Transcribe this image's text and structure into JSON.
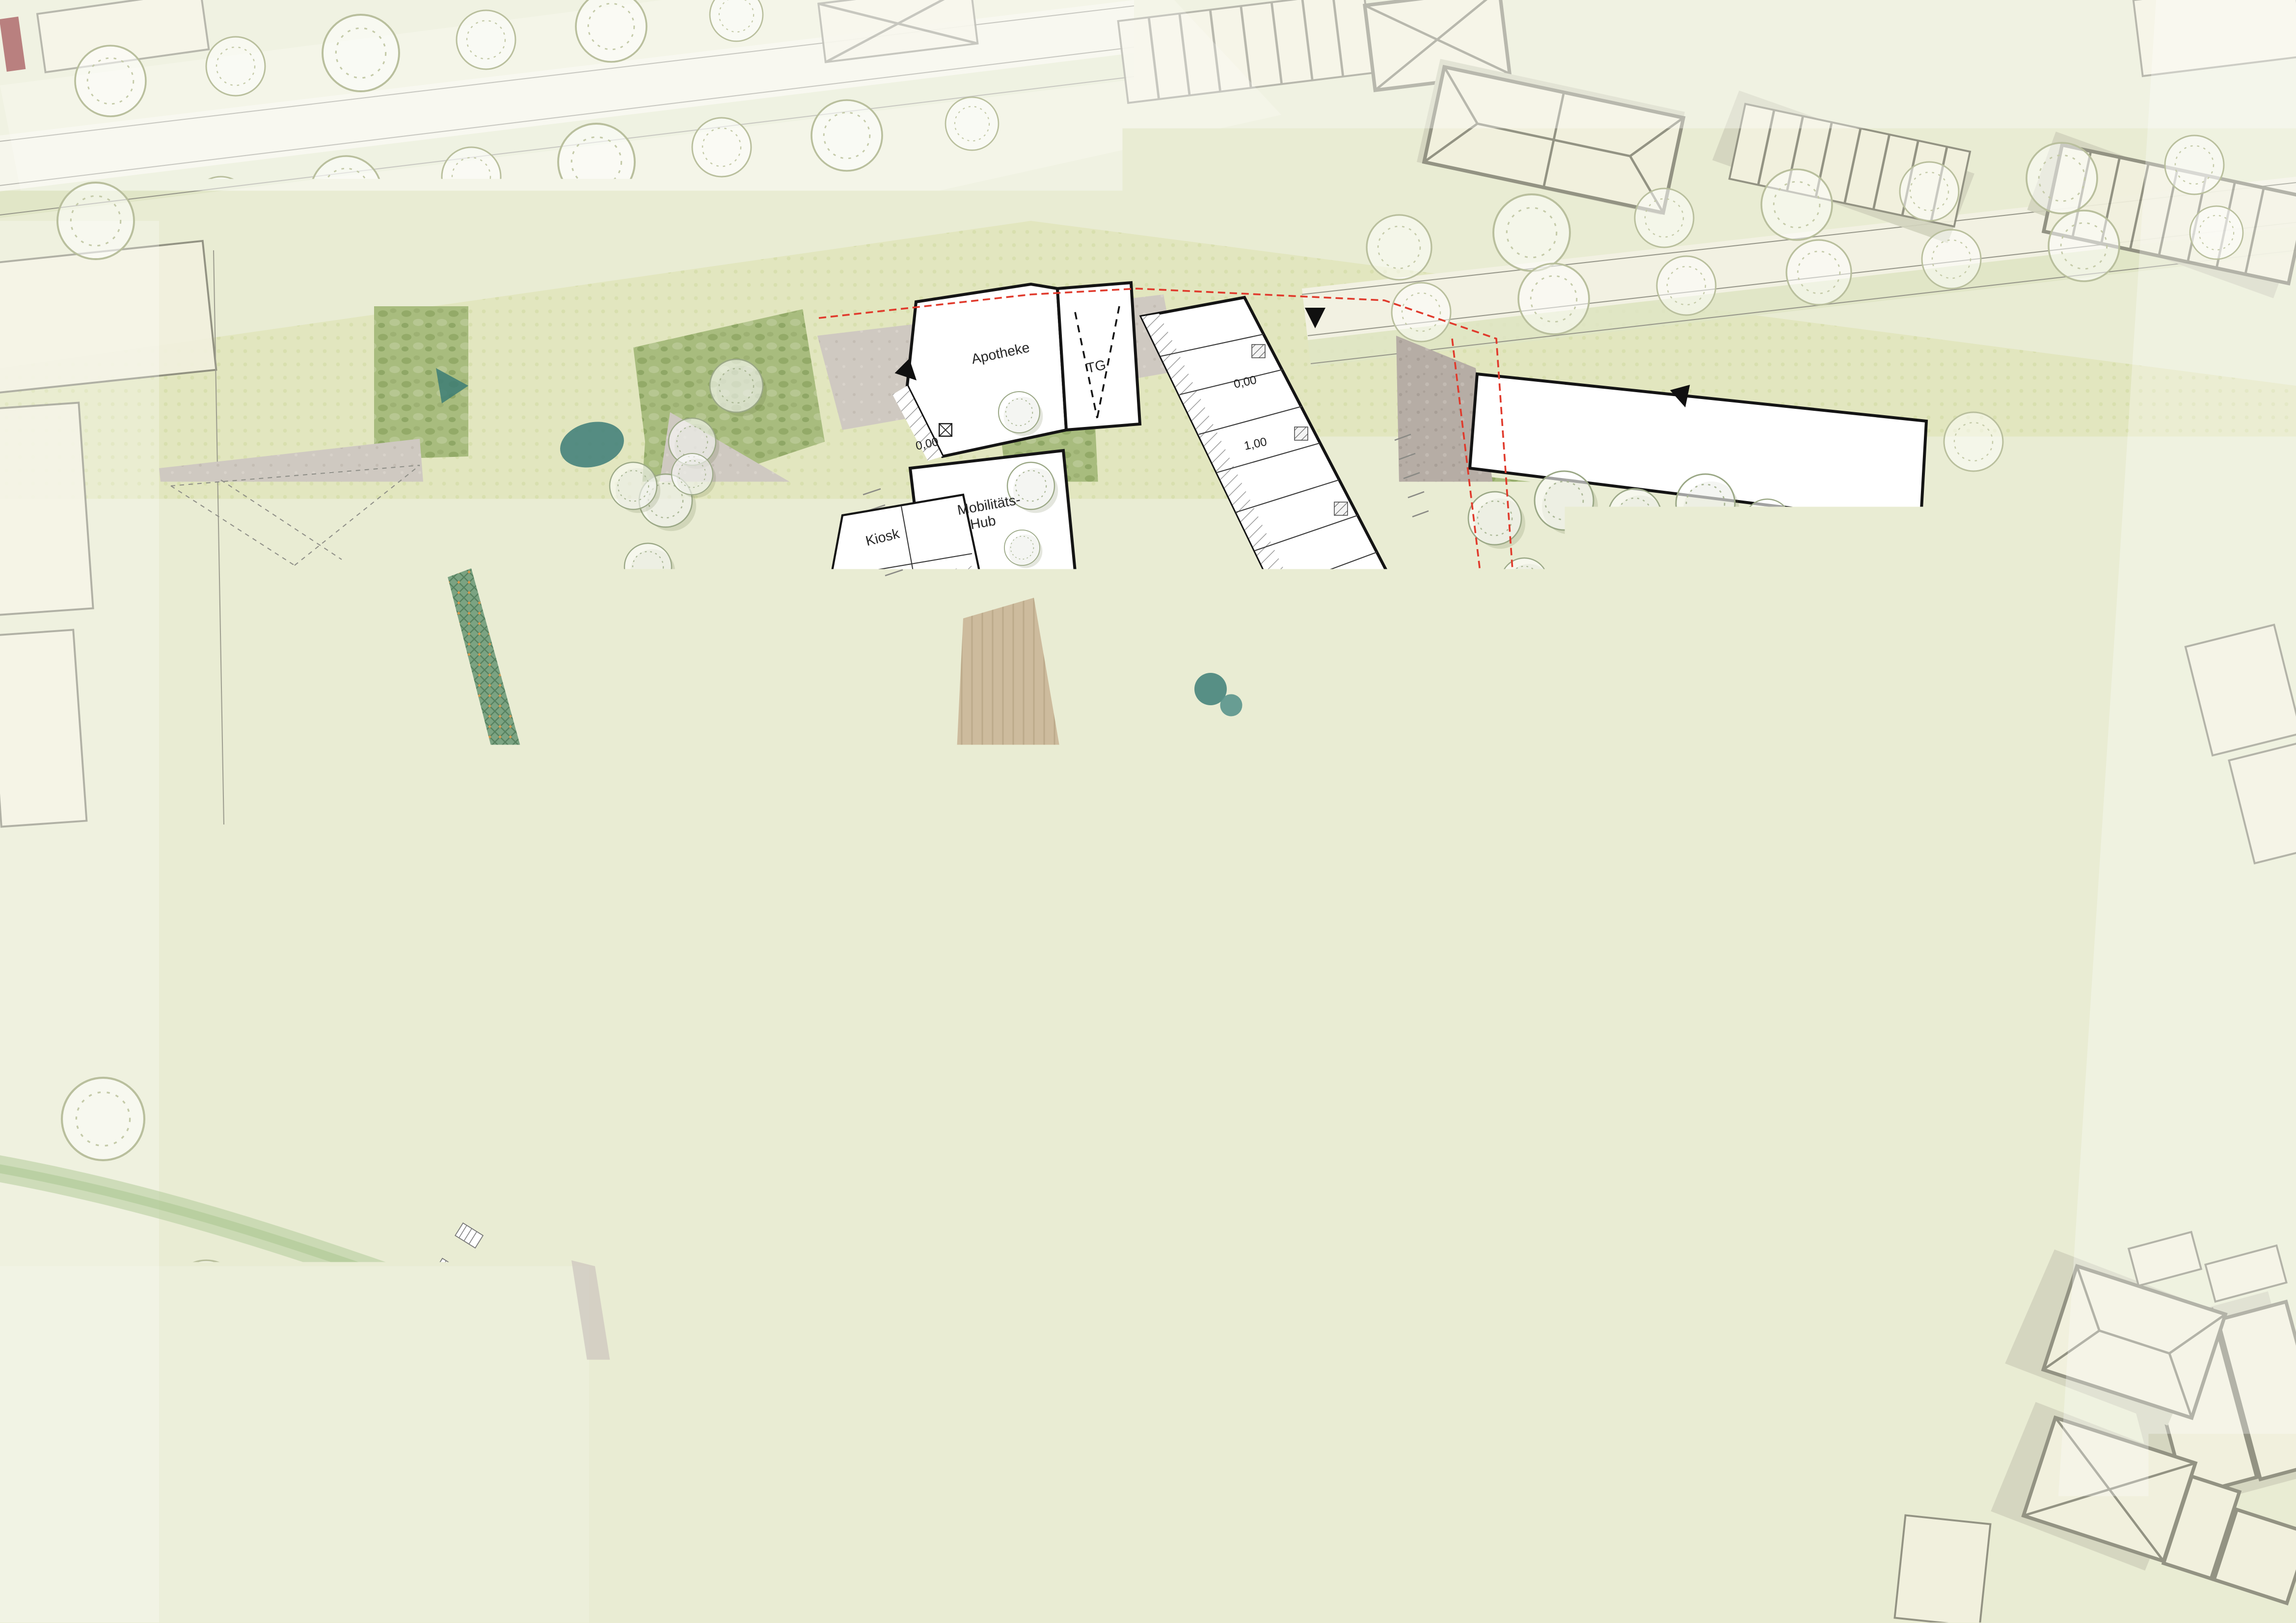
{
  "plan": {
    "labels": [
      {
        "text": "Apotheke"
      },
      {
        "text": "TG"
      },
      {
        "text": "Mobilitäts-"
      },
      {
        "text": "Hub"
      },
      {
        "text": "Kiosk"
      },
      {
        "text": "Quartiers-"
      },
      {
        "text": "Waschraum"
      },
      {
        "text": "Lobby"
      },
      {
        "text": "Gewerbe"
      },
      {
        "text": "Büro u. Verw."
      },
      {
        "text": "für Micro-Wo"
      },
      {
        "text": "Boarding-"
      },
      {
        "text": "House"
      },
      {
        "text": "Co-Working"
      },
      {
        "text": "Repair-Café / Werkstatt"
      },
      {
        "text": "fürs Quartier"
      },
      {
        "text": "Quartiers- bzw."
      },
      {
        "text": "Nachbarschafts-"
      },
      {
        "text": "treff"
      },
      {
        "text": "Kiosk u."
      },
      {
        "text": "Paketannahme-"
      },
      {
        "text": "stelle"
      },
      {
        "text": "Laden"
      },
      {
        "text": "Café"
      }
    ],
    "levels": [
      {
        "text": "0,00"
      },
      {
        "text": "0,00"
      },
      {
        "text": "1,00"
      },
      {
        "text": "0,00"
      },
      {
        "text": "1,00"
      },
      {
        "text": "1,00"
      },
      {
        "text": "0,00"
      },
      {
        "text": "0,50"
      },
      {
        "text": "1,00"
      },
      {
        "text": "0,00"
      }
    ],
    "symbols": {
      "entrance_arrow": "black filled triangle",
      "parasol": "teal octagon with radial ribs",
      "play_sail": "yellow concave sail canopy",
      "tree": "translucent white canopy circle",
      "elevator": "square with X",
      "underground_garage_ramp": "dashed V lines"
    },
    "colors": {
      "boundary_red": "#e03a2c",
      "water_teal": "#3f7f78",
      "swale_green": "#7ba382",
      "swale_blue": "#87a6c6",
      "play_sail_yellow": "#c2a43c",
      "bush_green": "#a8bc7e",
      "plaza_granite": "#b6ada5",
      "wood_deck": "#cdbb9d",
      "context_building": "#f1f0de",
      "lawn": "#e3e7c0"
    }
  }
}
